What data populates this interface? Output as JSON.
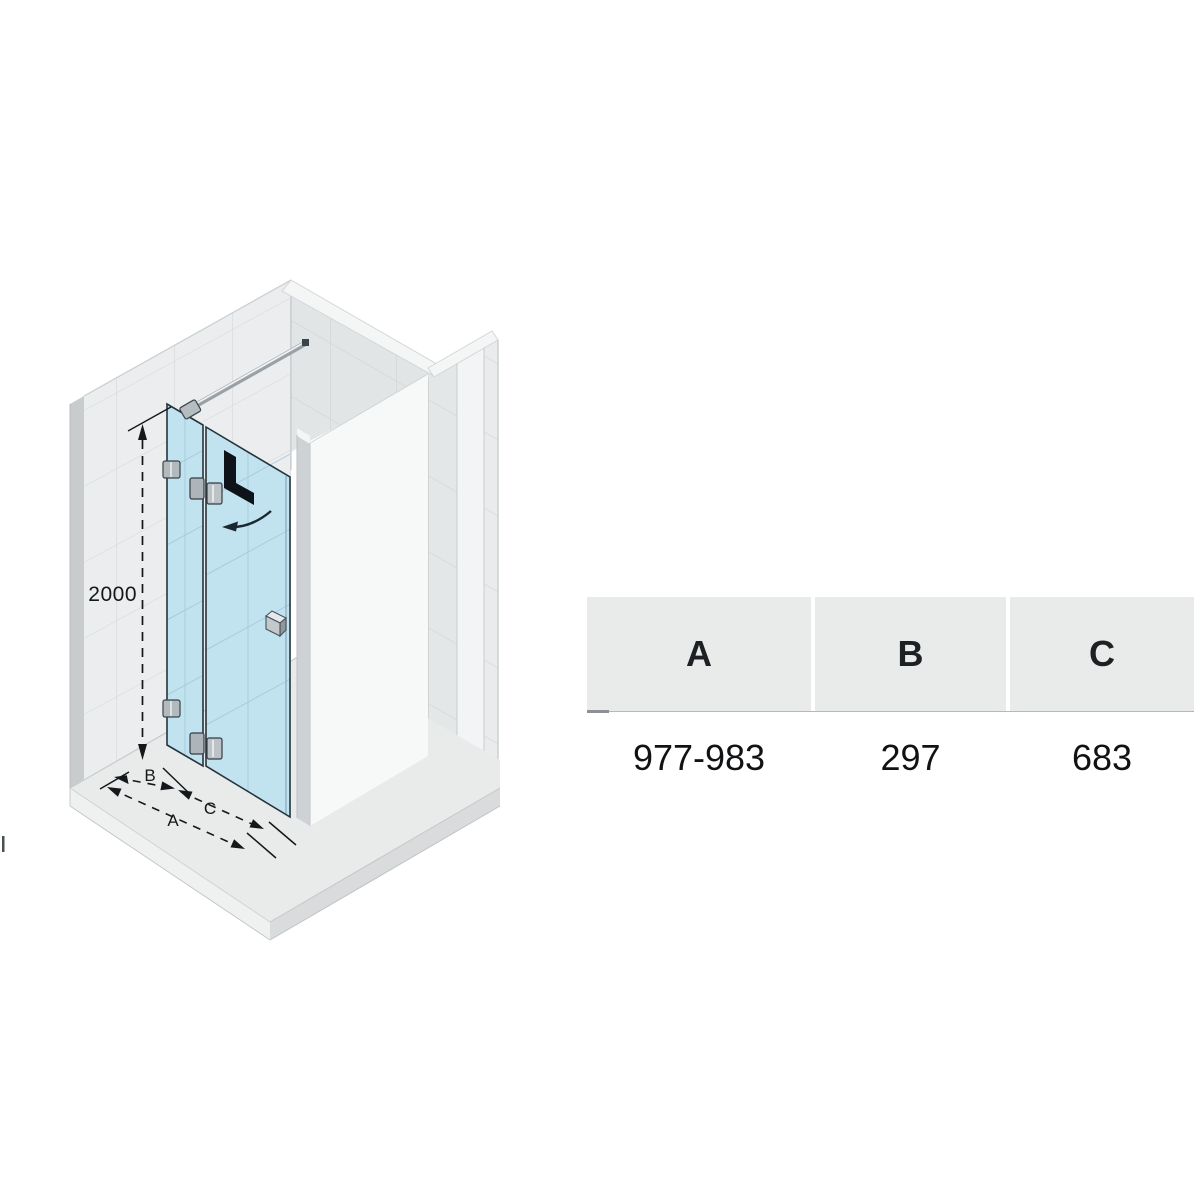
{
  "diagram": {
    "height_label": "2000",
    "dim_a_label": "A",
    "dim_b_label": "B",
    "dim_c_label": "C",
    "door_marking": "L"
  },
  "table": {
    "columns": [
      {
        "header": "A",
        "value": "977-983"
      },
      {
        "header": "B",
        "value": "297"
      },
      {
        "header": "C",
        "value": "683"
      }
    ]
  },
  "colors": {
    "glass": "#c1e2ef",
    "glass_edge": "#26333c",
    "wall_tile": "#ebedee",
    "tile_line": "#d6d9da",
    "floor": "#e9ebeb",
    "chrome": "#9aa1a6",
    "table_header_bg": "#e9eaea",
    "dim_line": "#14181b"
  }
}
